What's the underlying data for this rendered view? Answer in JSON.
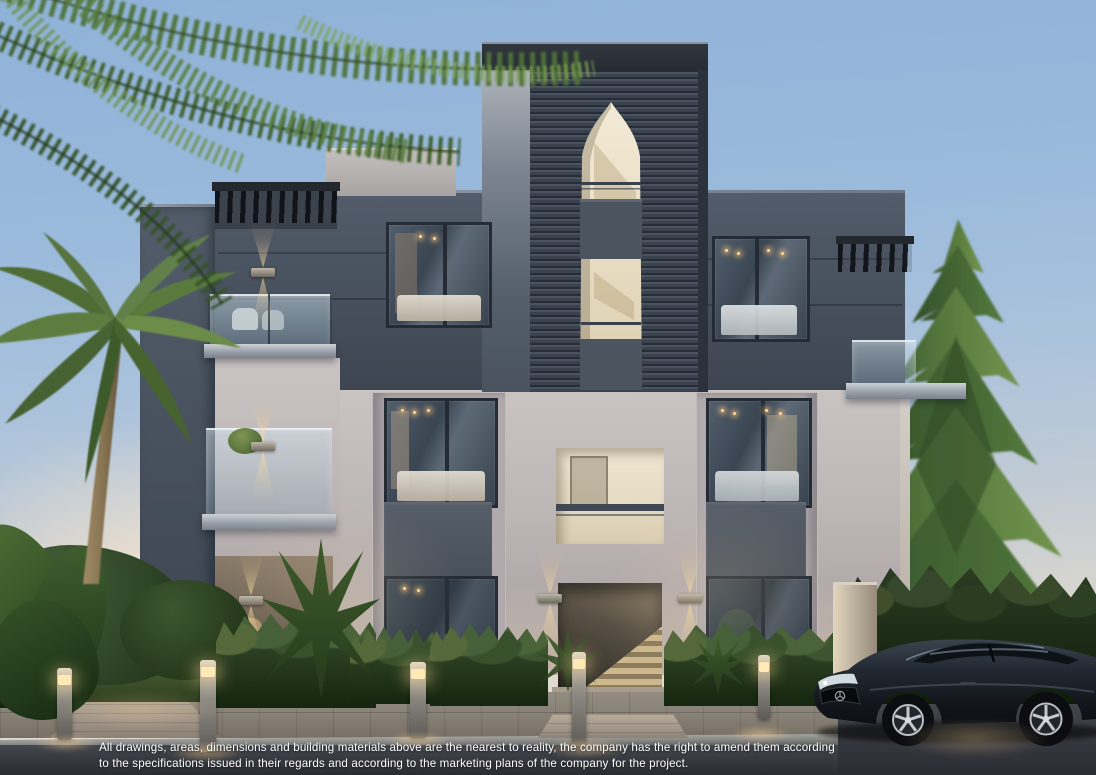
{
  "caption": {
    "line1": "All drawings, areas, dimensions and building materials above are the nearest to reality, the company has the right to amend them according",
    "line2": "to the specifications issued in their regards and according to the marketing plans of the company for the project."
  },
  "palette": {
    "sky_top": "#8fb2d8",
    "sky_horizon": "#efe4d6",
    "facade_dark": "#49525f",
    "facade_light": "#c6c0bf",
    "louver_tower": "#39414c",
    "arch_interior": "#e9dfc6",
    "warm_light": "#f2cf96",
    "foliage": "#4e6d35",
    "road": "#33363c",
    "car_body": "#23282e",
    "caption_text": "#ffffff"
  }
}
